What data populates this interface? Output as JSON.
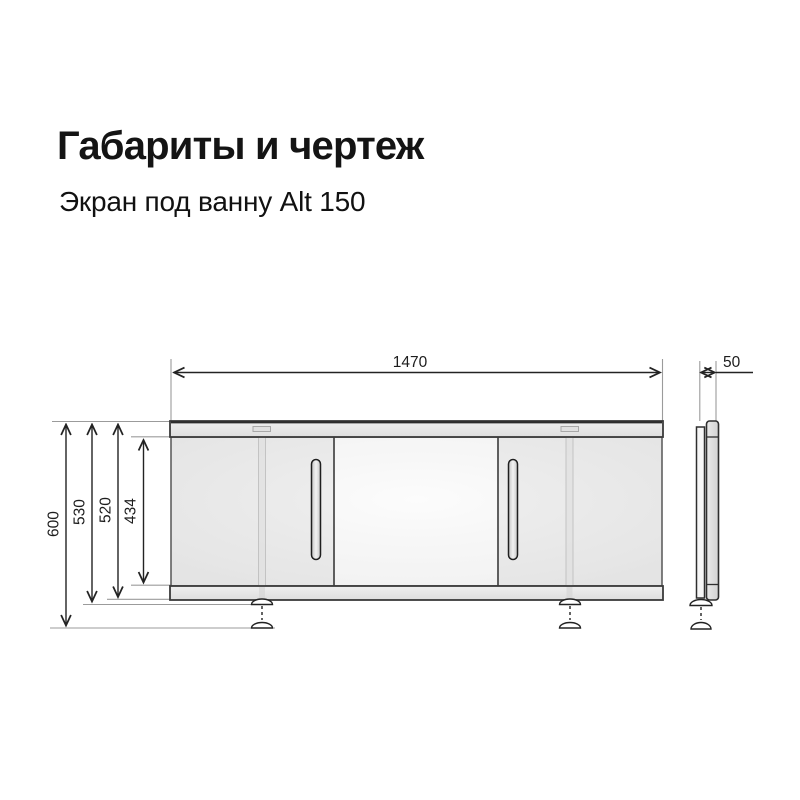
{
  "header": {
    "title": "Габариты и чертеж",
    "subtitle": "Экран под ванну Alt 150"
  },
  "drawing": {
    "type": "technical-dimension-drawing",
    "views": [
      "front",
      "side"
    ],
    "front_view": {
      "width_mm": "1470",
      "overall_height_feet_extended_mm": "600",
      "height_feet_retracted_mm": "530",
      "frame_height_mm": "520",
      "door_panel_height_mm": "434",
      "doors": 3,
      "handles": 2,
      "adjustable_feet": 2
    },
    "side_view": {
      "depth_mm": "50"
    },
    "colors": {
      "background": "#ffffff",
      "outline": "#2e2e2e",
      "dimension_line": "#232323",
      "extension_line": "#9b9b9b",
      "panel_fill": "#efefef",
      "rail_fill": "#e4e4e4",
      "text": "#1d1d1d"
    }
  }
}
